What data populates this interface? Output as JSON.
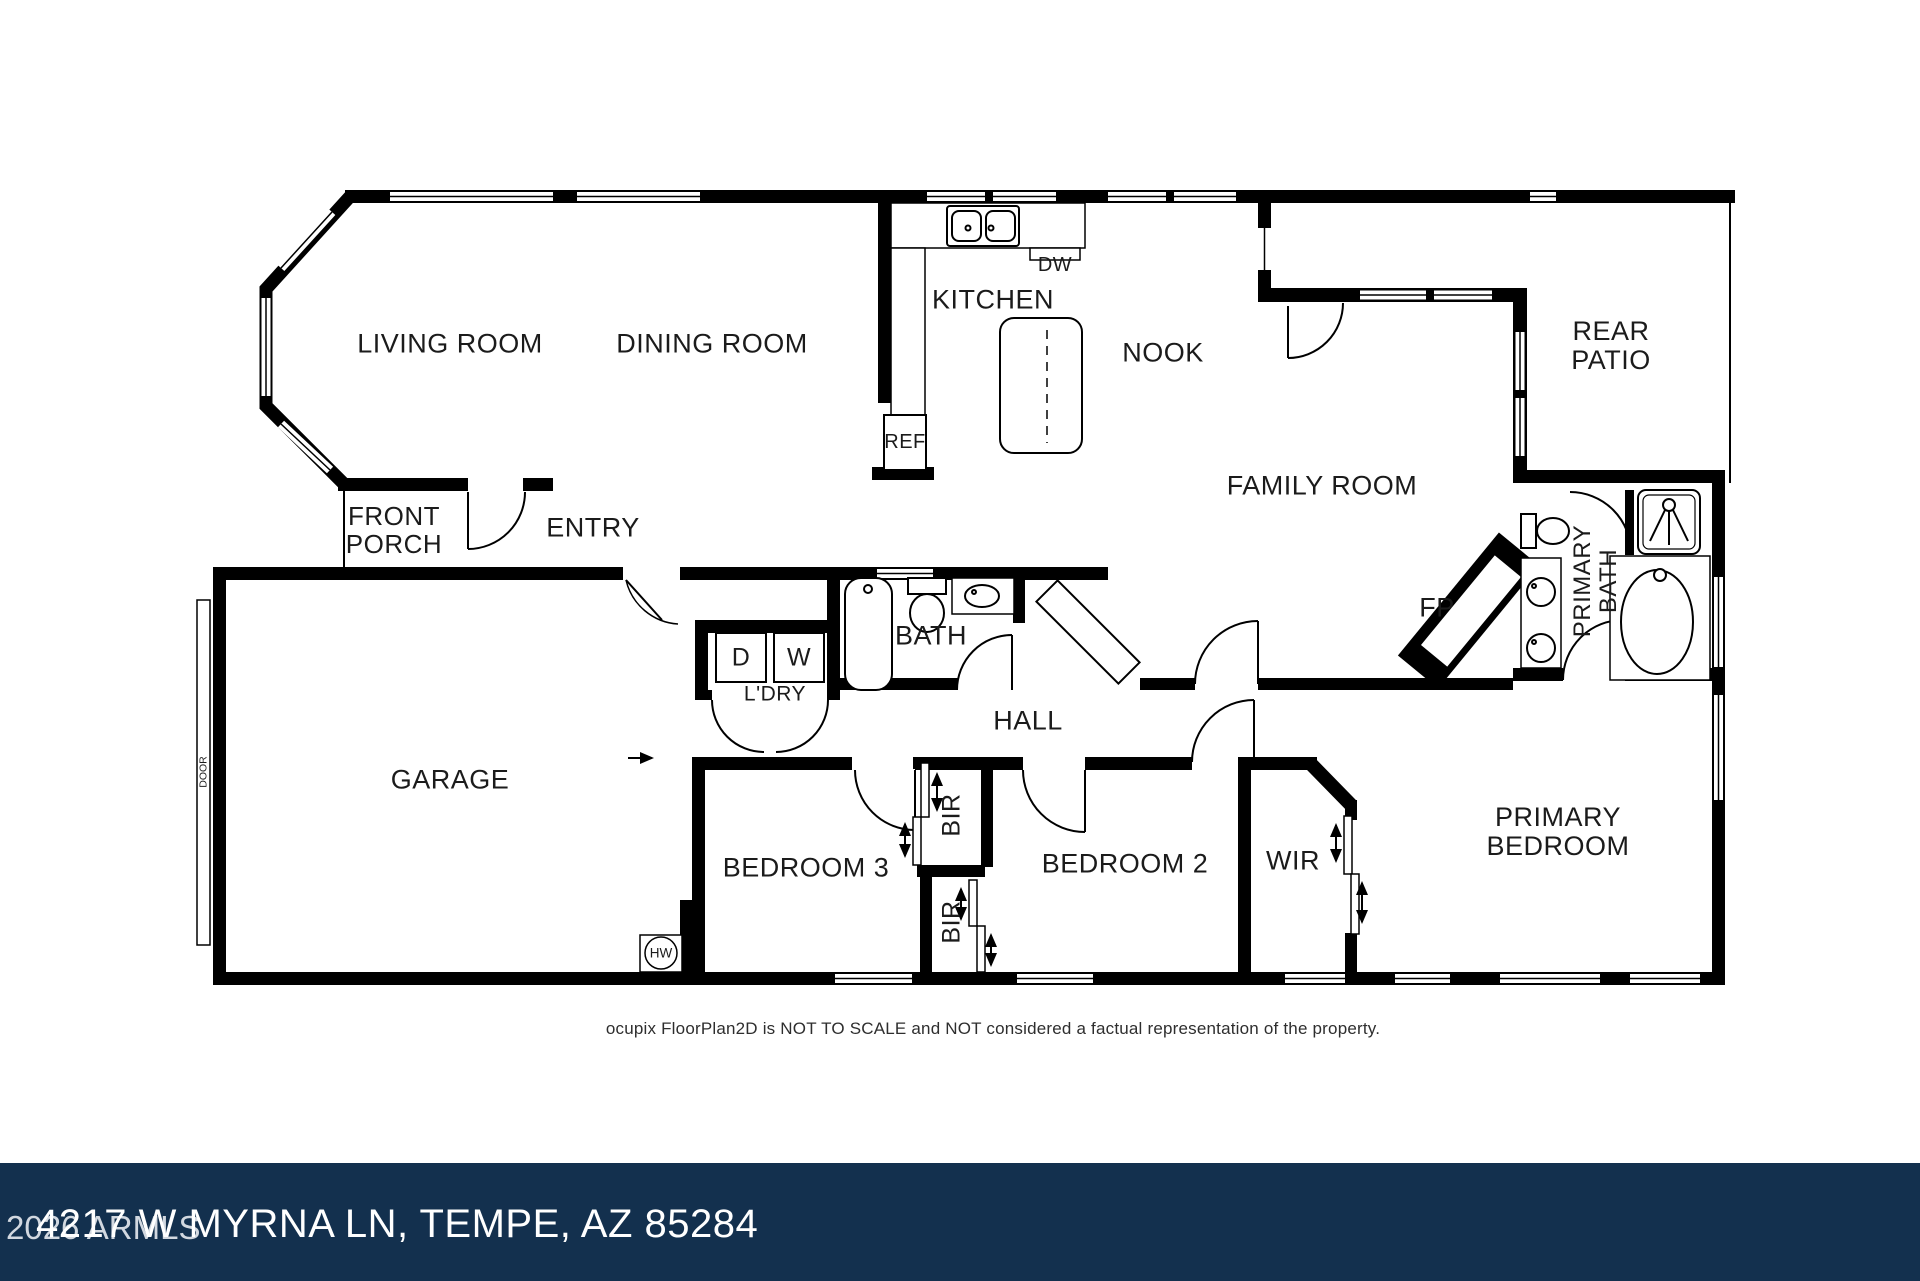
{
  "page": {
    "disclaimer": "ocupix FloorPlan2D is NOT TO SCALE and NOT considered a factual representation of the property.",
    "watermark": "2026 ARMLS",
    "address": "4217 W MYRNA LN, TEMPE, AZ 85284"
  },
  "colors": {
    "wall": "#000000",
    "paper": "#ffffff",
    "bar_background": "#13304e",
    "label_text": "#1b1b1b",
    "disclaimer_text": "#2e2e2e",
    "address_text": "#ffffff",
    "watermark_text": "#dde2e8"
  },
  "rooms": {
    "living_room": "LIVING ROOM",
    "dining_room": "DINING ROOM",
    "kitchen": "KITCHEN",
    "nook": "NOOK",
    "rear_patio": "REAR PATIO",
    "family_room": "FAMILY ROOM",
    "front_porch": "FRONT PORCH",
    "entry": "ENTRY",
    "bath": "BATH",
    "laundry": "L'DRY",
    "hall": "HALL",
    "garage": "GARAGE",
    "bedroom_3": "BEDROOM 3",
    "bedroom_2": "BEDROOM 2",
    "wir": "WIR",
    "primary_bedroom": "PRIMARY BEDROOM",
    "primary_bath": "PRIMARY BATH"
  },
  "fixtures": {
    "dishwasher": "DW",
    "refrigerator": "REF",
    "dryer": "D",
    "washer": "W",
    "fireplace": "FP",
    "water_heater": "HW",
    "built_in_robe_1": "BIR",
    "built_in_robe_2": "BIR",
    "garage_door": "DOOR"
  }
}
